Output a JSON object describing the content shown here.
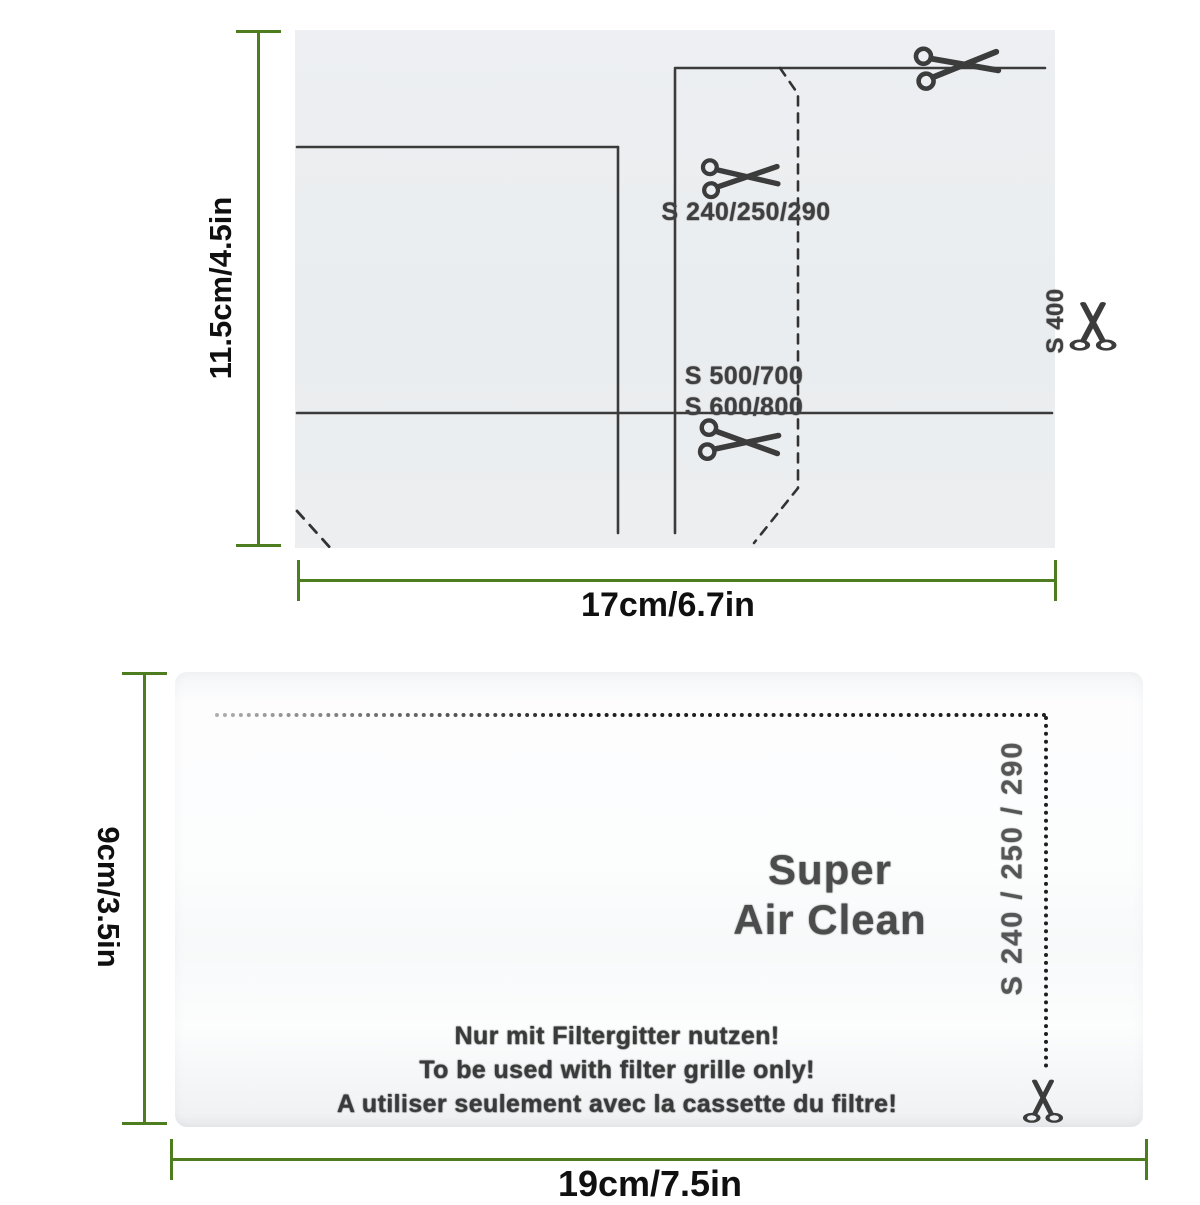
{
  "top_diagram": {
    "cut_line_1_label": "S 240/250/290",
    "cut_line_2_labels": [
      "S 500/700",
      "S 600/800"
    ],
    "vertical_cut_label": "S 400",
    "model_list": [
      "S 300",
      "S 2000",
      "S 4000",
      "S 5000",
      "S 7000"
    ],
    "height_label": "11.5cm/4.5in",
    "width_label": "17cm/6.7in"
  },
  "bottom_filter": {
    "brand_line_1": "Super",
    "brand_line_2": "Air Clean",
    "usage_notes": [
      "Nur mit Filtergitter nutzen!",
      "To be used with filter grille only!",
      "A utiliser seulement avec la cassette du filtre!"
    ],
    "side_cut_label": "S 240 / 250 / 290",
    "height_label": "9cm/3.5in",
    "width_label": "19cm/7.5in"
  },
  "colors": {
    "dimension_green": "#4e7d1f",
    "ink": "#3f3f3f",
    "dot_ink": "#1f1f1f",
    "brand_gray": "#4c4c4c"
  }
}
